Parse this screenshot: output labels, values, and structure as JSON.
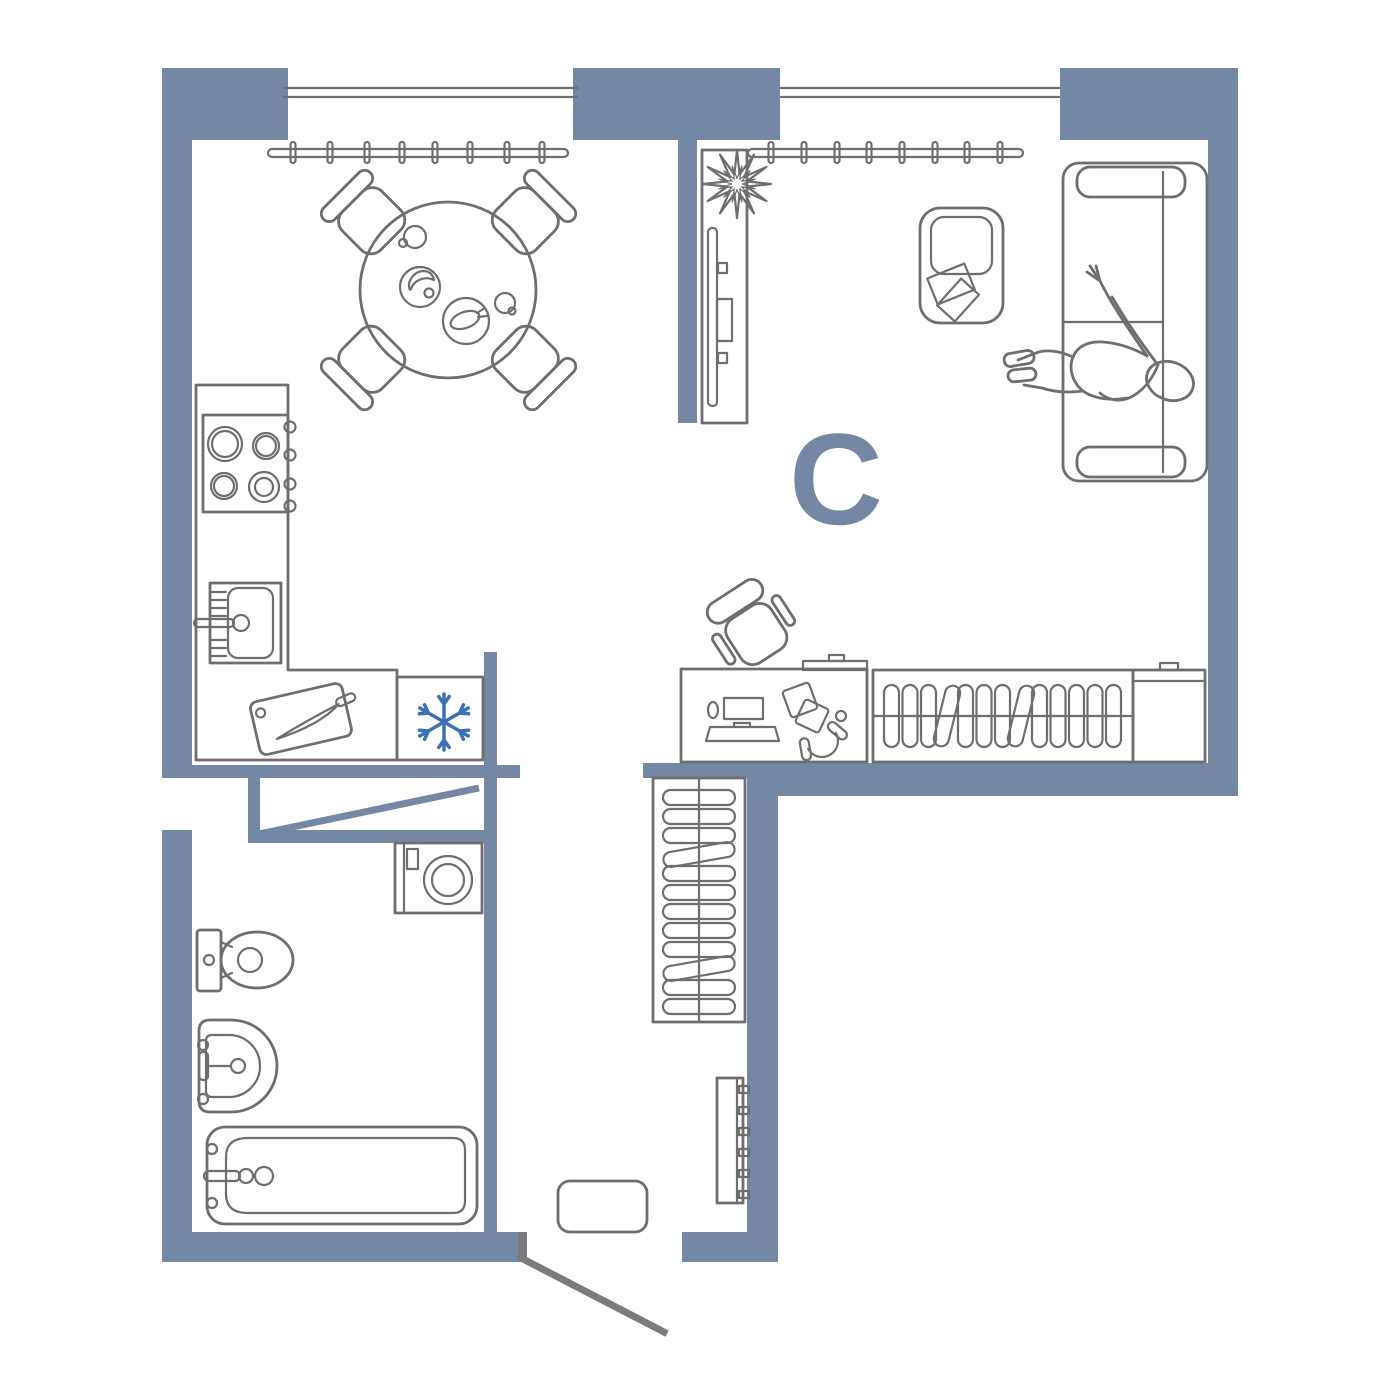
{
  "plan": {
    "compass_label": "C",
    "colors": {
      "wall": "#7487A5",
      "line": "#6E6E6E",
      "door": "#7B7B7B",
      "accent": "#3B70B8",
      "bg": "#FFFFFF"
    },
    "symbols": {
      "kitchen_dining": [
        "window",
        "curtain-rail",
        "dining-table",
        "chair",
        "kitchen-counter",
        "stove",
        "kitchen-sink",
        "cutting-board",
        "refrigerator-snowflake"
      ],
      "living_room": [
        "window",
        "curtain-rail",
        "tv-stand",
        "tv",
        "plant",
        "sofa",
        "person-lying",
        "ottoman",
        "magazines",
        "desk",
        "desk-chair",
        "computer",
        "headphones",
        "wardrobe-hangers",
        "wardrobe-cabinet"
      ],
      "hallway": [
        "closet-hangers",
        "shoe-rack",
        "doormat",
        "entrance-door"
      ],
      "bathroom": [
        "bathroom-door",
        "washing-machine",
        "toilet",
        "washbasin",
        "bathtub"
      ]
    }
  }
}
